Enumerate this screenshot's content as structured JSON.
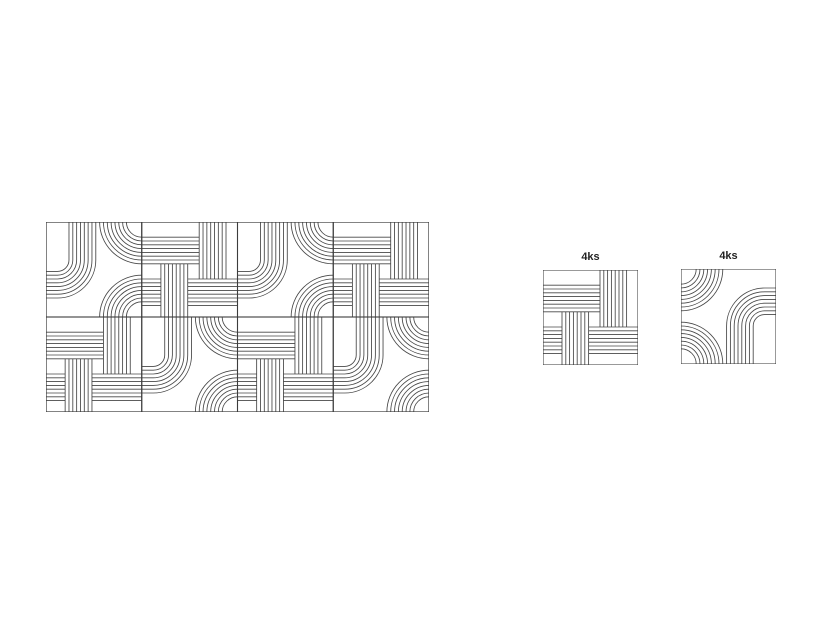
{
  "style": {
    "background": "#ffffff",
    "line_color": "#474747",
    "tile_border_color": "#3c3c3c",
    "label_color": "#222222"
  },
  "panel": {
    "rows": 2,
    "cols": 4,
    "grid": [
      [
        "curve",
        "weave",
        "curve",
        "weave"
      ],
      [
        "weave",
        "curve",
        "weave",
        "curve"
      ]
    ],
    "tile_rotation_deg": 0
  },
  "reference_tiles": [
    {
      "label": "4ks",
      "type": "weave",
      "rotation_deg": 0
    },
    {
      "label": "4ks",
      "type": "curve",
      "rotation_deg": 180
    }
  ],
  "tile_geometry": {
    "tile_units": 100,
    "lines_per_bundle": 8,
    "line_spacing": 4,
    "weave": {
      "h_bundles": [
        {
          "y0": 16,
          "x1": 0,
          "x2": 60
        },
        {
          "y0": 60,
          "x1": 48,
          "x2": 100
        },
        {
          "y0": 60,
          "x1": 0,
          "x2": 20
        }
      ],
      "v_bundles": [
        {
          "x0": 60,
          "y1": 0,
          "y2": 60
        },
        {
          "x0": 20,
          "y1": 44,
          "y2": 100
        }
      ]
    },
    "curve": {
      "j_bundle": {
        "x0": 24,
        "corner_x": 12,
        "corner_y": 40
      },
      "corner_arcs": [
        {
          "corner": "top-right",
          "r0": 16
        },
        {
          "corner": "bottom-right",
          "r0": 16
        }
      ]
    }
  }
}
